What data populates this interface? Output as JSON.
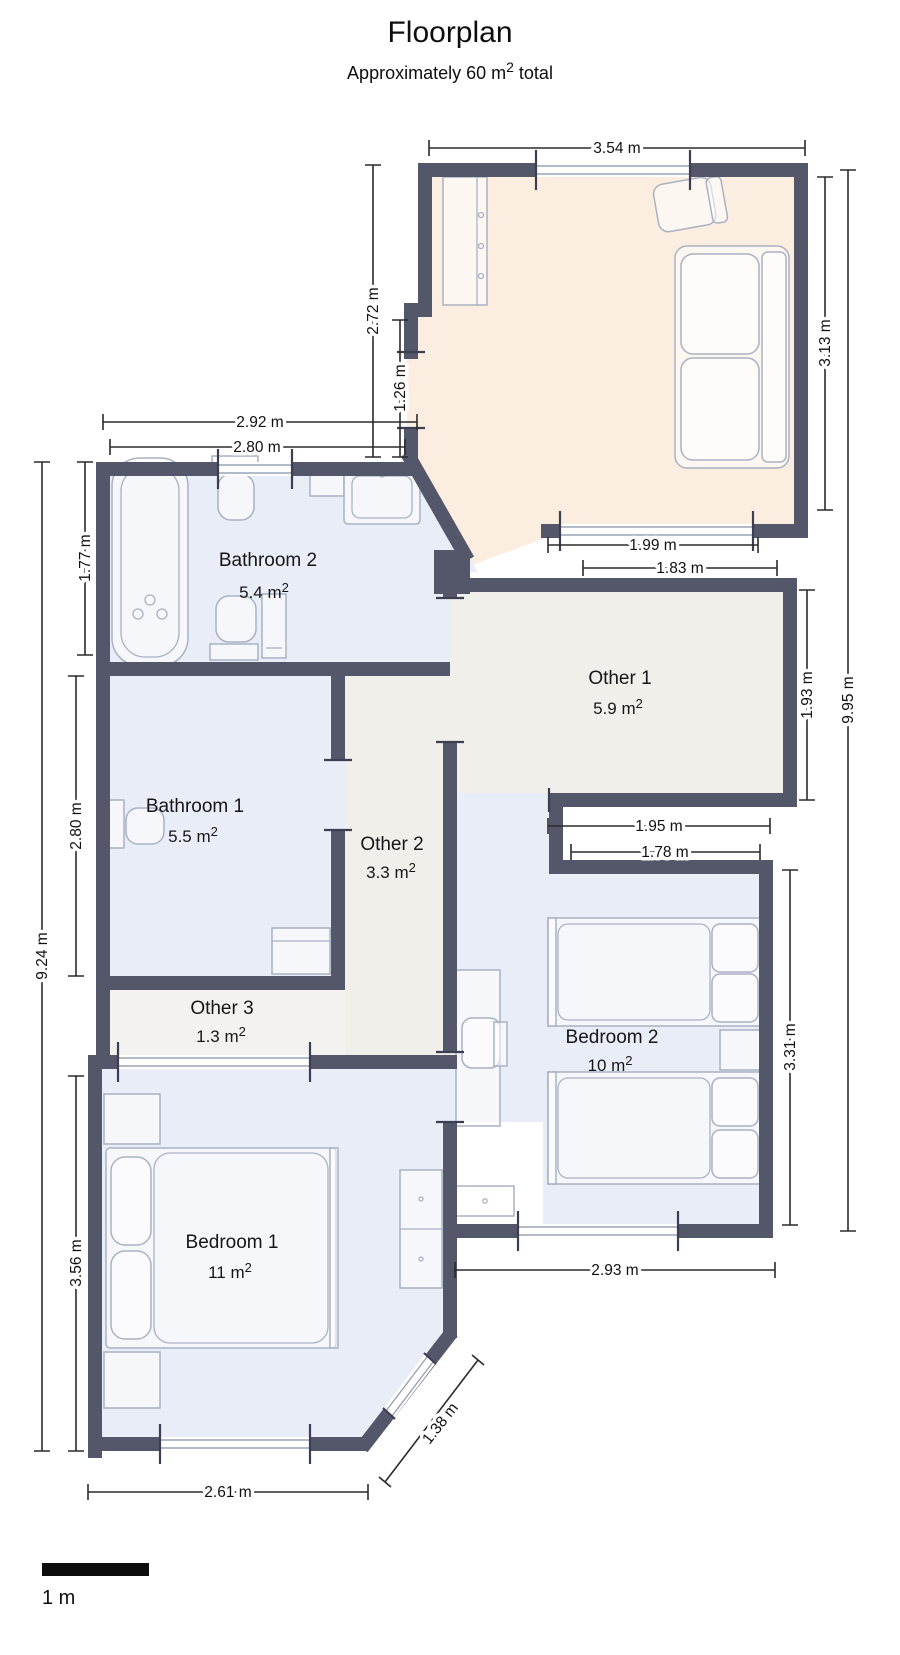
{
  "title": "Floorplan",
  "subtitle": {
    "prefix": "Approximately 60 m",
    "sup": "2",
    "suffix": " total"
  },
  "scale_bar_label": "1 m",
  "colors": {
    "wall": "#535769",
    "room_blue": "#e8edf7",
    "room_beige": "#f0efe9",
    "room_beige_light": "#f3f2ee",
    "room_peach": "#fbeee1",
    "dimension_line": "#2b2b2b",
    "furniture_stroke": "#a9b1c3"
  },
  "rooms": {
    "bathroom2": {
      "name": "Bathroom 2",
      "area": "5.4 m",
      "area_sup": "2"
    },
    "other1": {
      "name": "Other 1",
      "area": "5.9 m",
      "area_sup": "2"
    },
    "bathroom1": {
      "name": "Bathroom 1",
      "area": "5.5 m",
      "area_sup": "2"
    },
    "other2": {
      "name": "Other 2",
      "area": "3.3 m",
      "area_sup": "2"
    },
    "other3": {
      "name": "Other 3",
      "area": "1.3 m",
      "area_sup": "2"
    },
    "bedroom1": {
      "name": "Bedroom 1",
      "area": "11 m",
      "area_sup": "2"
    },
    "bedroom2": {
      "name": "Bedroom 2",
      "area": "10 m",
      "area_sup": "2"
    }
  },
  "dims": {
    "top_width": "3.54 m",
    "living_left_upper": "2.72 m",
    "living_left_lower": "1.26 m",
    "bath2_outer": "2.92 m",
    "bath2_inner": "2.80 m",
    "living_right": "3.13 m",
    "overall_right": "9.95 m",
    "living_window": "1.99 m",
    "other1_top": "1.83 m",
    "bath2_left": "1.77 m",
    "other1_right": "1.93 m",
    "bath1_left": "2.80 m",
    "overall_left": "9.24 m",
    "other1_bottom": "1.95 m",
    "bedroom2_top": "1.78 m",
    "bedroom2_right": "3.31 m",
    "bedroom1_left": "3.56 m",
    "bedroom2_bottom": "2.93 m",
    "bedroom1_chamfer": "1.38 m",
    "bedroom1_bottom": "2.61 m"
  }
}
